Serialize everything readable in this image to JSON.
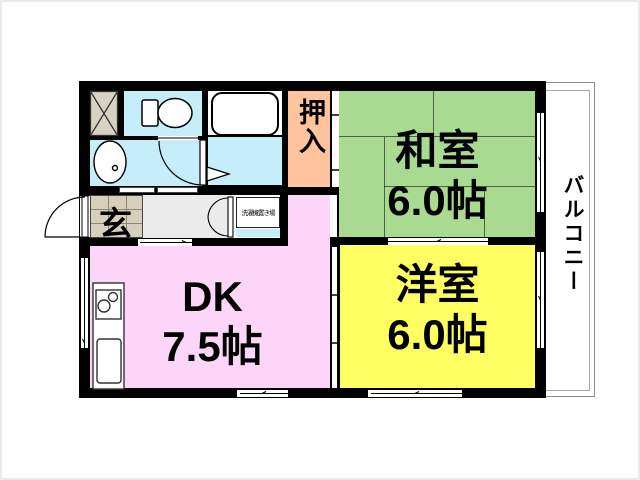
{
  "plan": {
    "rooms": {
      "washitsu": {
        "name": "和室",
        "size": "6.0帖",
        "color": "#a8da92"
      },
      "yoshitsu": {
        "name": "洋室",
        "size": "6.0帖",
        "color": "#ffff63"
      },
      "dk": {
        "name": "DK",
        "size": "7.5帖",
        "color": "#fcd6f8"
      },
      "oshiire": {
        "name": "押入",
        "color": "#ffc49e"
      },
      "genkan": {
        "name": "玄",
        "color": "#d6cfbc"
      },
      "balcony": {
        "name": "バルコニー"
      },
      "laundry": {
        "name": "洗濯機置き場"
      }
    },
    "colors": {
      "wall": "#000000",
      "water": "#c5edfa",
      "hallway": "#ebebeb",
      "storage_box": "#d8d2c2"
    }
  }
}
